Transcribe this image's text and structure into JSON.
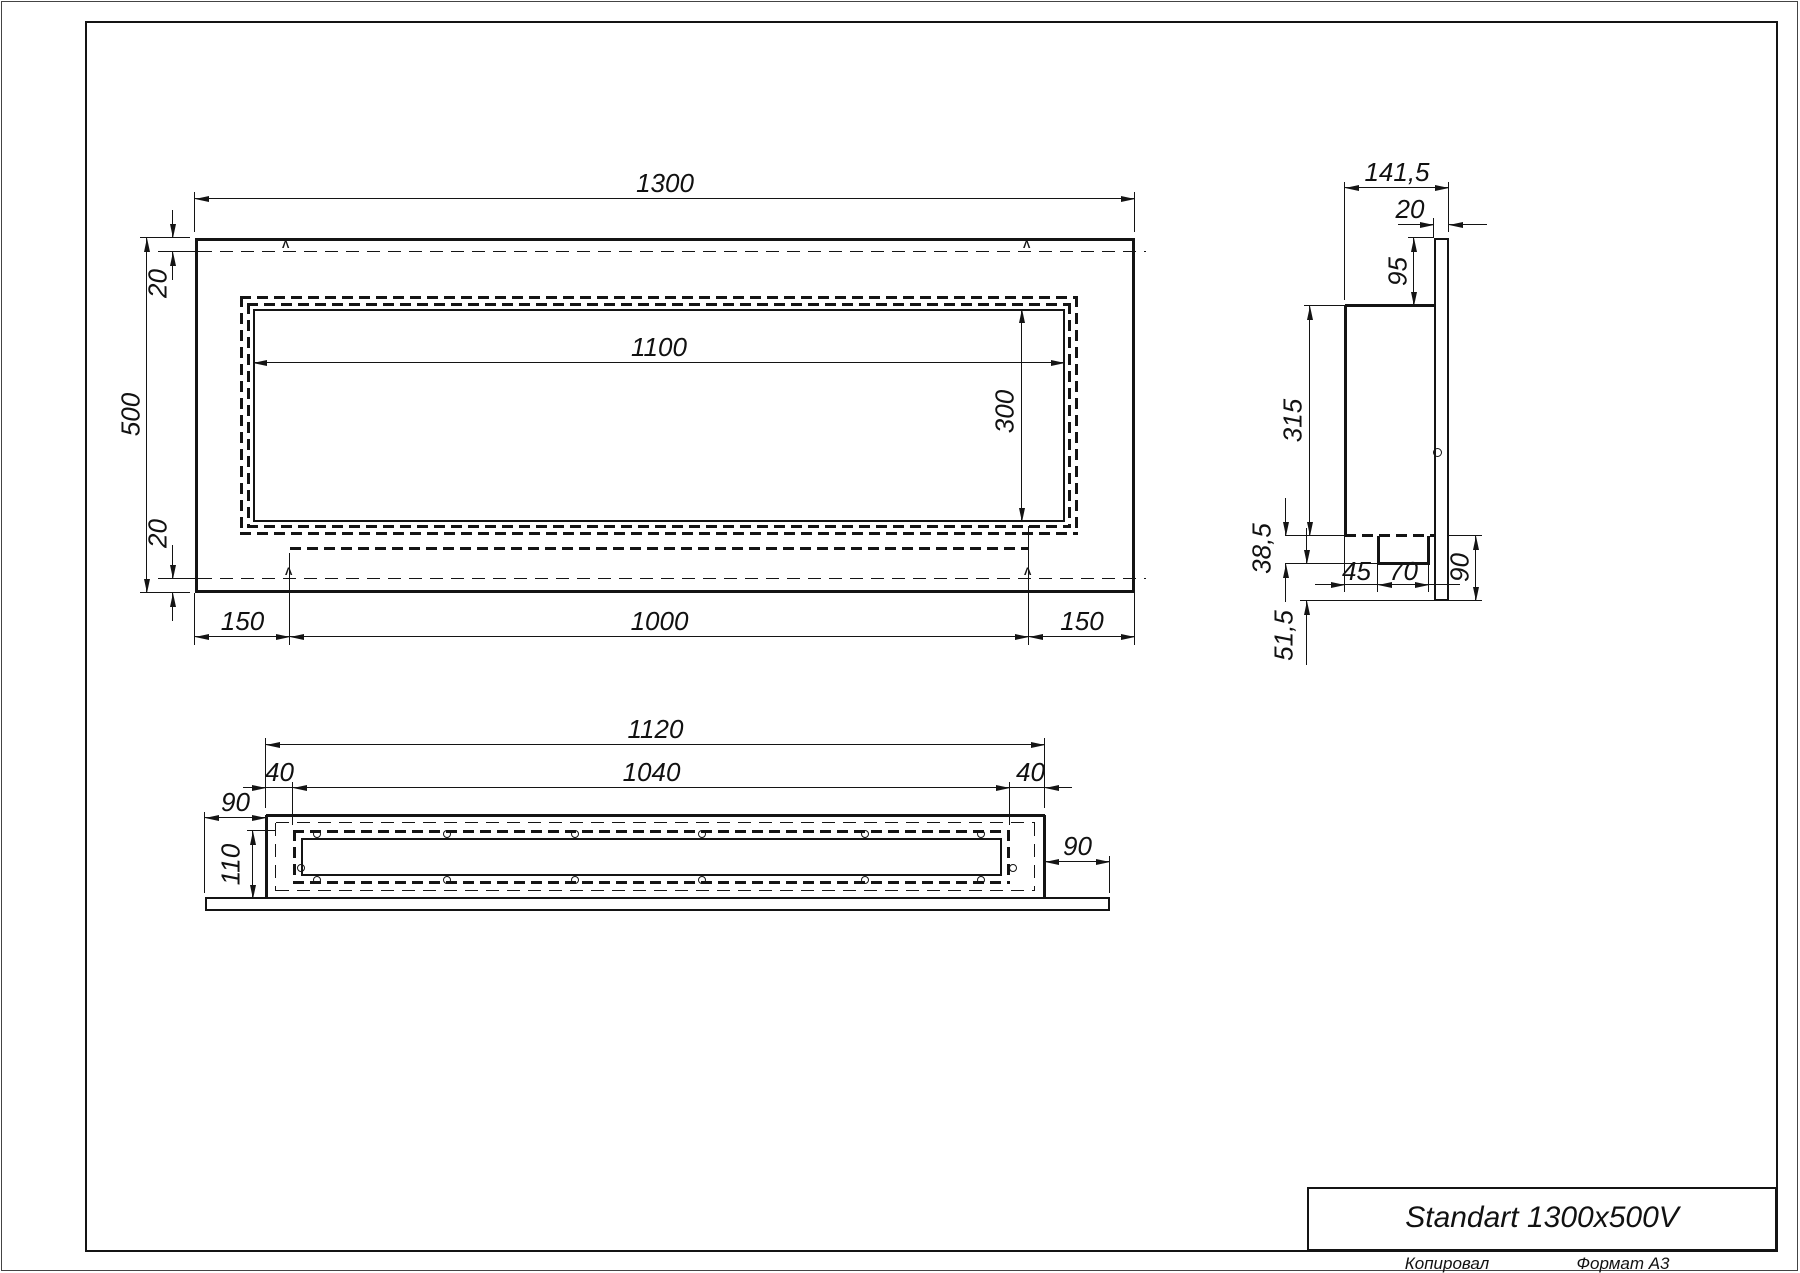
{
  "title_block": {
    "product_name": "Standart 1300x500V"
  },
  "footer": {
    "copied": "Копировал",
    "format": "Формат А3"
  },
  "front_view": {
    "dims": {
      "overall_width": "1300",
      "overall_height": "500",
      "top_inset": "20",
      "bottom_inset": "20",
      "opening_width": "1100",
      "opening_height": "300",
      "left_margin": "150",
      "slot_width": "1000",
      "right_margin": "150"
    }
  },
  "side_view": {
    "dims": {
      "overall_depth": "141,5",
      "flange_thickness": "20",
      "flange_top_offset": "95",
      "body_height": "315",
      "tray_setback": "45",
      "tray_depth": "70",
      "tray_height": "38,5",
      "flange_bottom_drop": "90",
      "bottom_clearance": "51,5"
    }
  },
  "top_view": {
    "dims": {
      "body_width": "1120",
      "opening_width": "1040",
      "inset_left": "40",
      "inset_right": "40",
      "overhang_left": "90",
      "overhang_right": "90",
      "body_depth": "110"
    }
  }
}
